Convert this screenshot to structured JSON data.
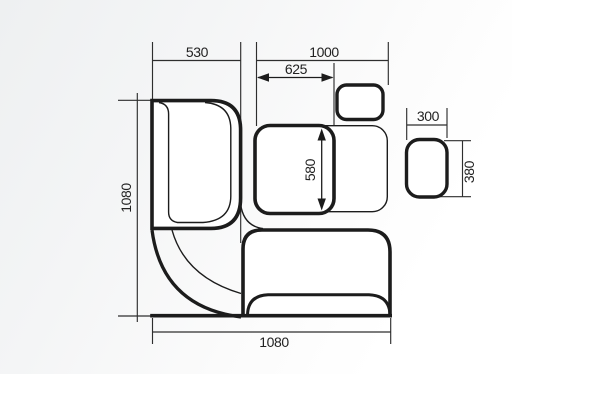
{
  "drawing": {
    "title": "corner bench seating plan view",
    "colors": {
      "line": "#1c1c1c",
      "text": "#222222",
      "background_tint": "#eef0f1"
    },
    "dimensions": {
      "left_bench_width": "530",
      "table_zone_width": "1000",
      "table_offset": "625",
      "table_depth": "580",
      "left_side_depth": "1080",
      "bottom_side_width": "1080",
      "stool_width": "300",
      "stool_depth": "380"
    }
  }
}
